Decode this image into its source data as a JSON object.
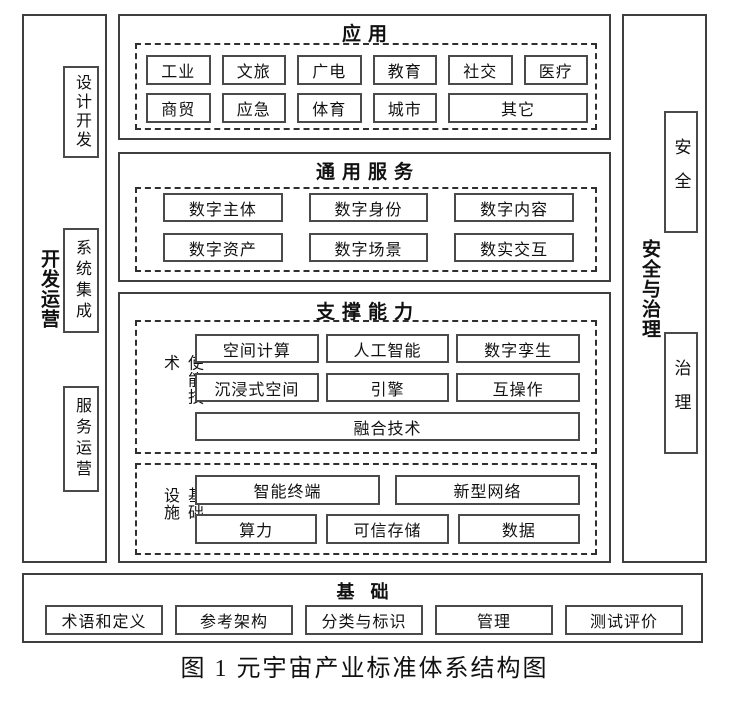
{
  "figure": {
    "caption": "图 1 元宇宙产业标准体系结构图"
  },
  "colors": {
    "line": "#3f3f3f",
    "text": "#111111",
    "background": "#ffffff"
  },
  "left_sidebar": {
    "label": "开发运营",
    "boxes": [
      "设计开发",
      "系统集成",
      "服务运营"
    ]
  },
  "right_sidebar": {
    "label": "安全与治理",
    "boxes": [
      "安全",
      "治理"
    ]
  },
  "application": {
    "title": "应用",
    "row1": [
      "工业",
      "文旅",
      "广电",
      "教育",
      "社交",
      "医疗"
    ],
    "row2": [
      "商贸",
      "应急",
      "体育",
      "城市",
      "其它"
    ]
  },
  "general_services": {
    "title": "通用服务",
    "row1": [
      "数字主体",
      "数字身份",
      "数字内容"
    ],
    "row2": [
      "数字资产",
      "数字场景",
      "数实交互"
    ]
  },
  "supporting": {
    "title": "支撑能力",
    "enabling": {
      "label": "使能技术",
      "row1": [
        "空间计算",
        "人工智能",
        "数字孪生"
      ],
      "row2": [
        "沉浸式空间",
        "引擎",
        "互操作"
      ],
      "row3": "融合技术"
    },
    "infrastructure": {
      "label": "基础设施",
      "row1": [
        "智能终端",
        "新型网络"
      ],
      "row2": [
        "算力",
        "可信存储",
        "数据"
      ]
    }
  },
  "foundation": {
    "title": "基础",
    "boxes": [
      "术语和定义",
      "参考架构",
      "分类与标识",
      "管理",
      "测试评价"
    ]
  }
}
